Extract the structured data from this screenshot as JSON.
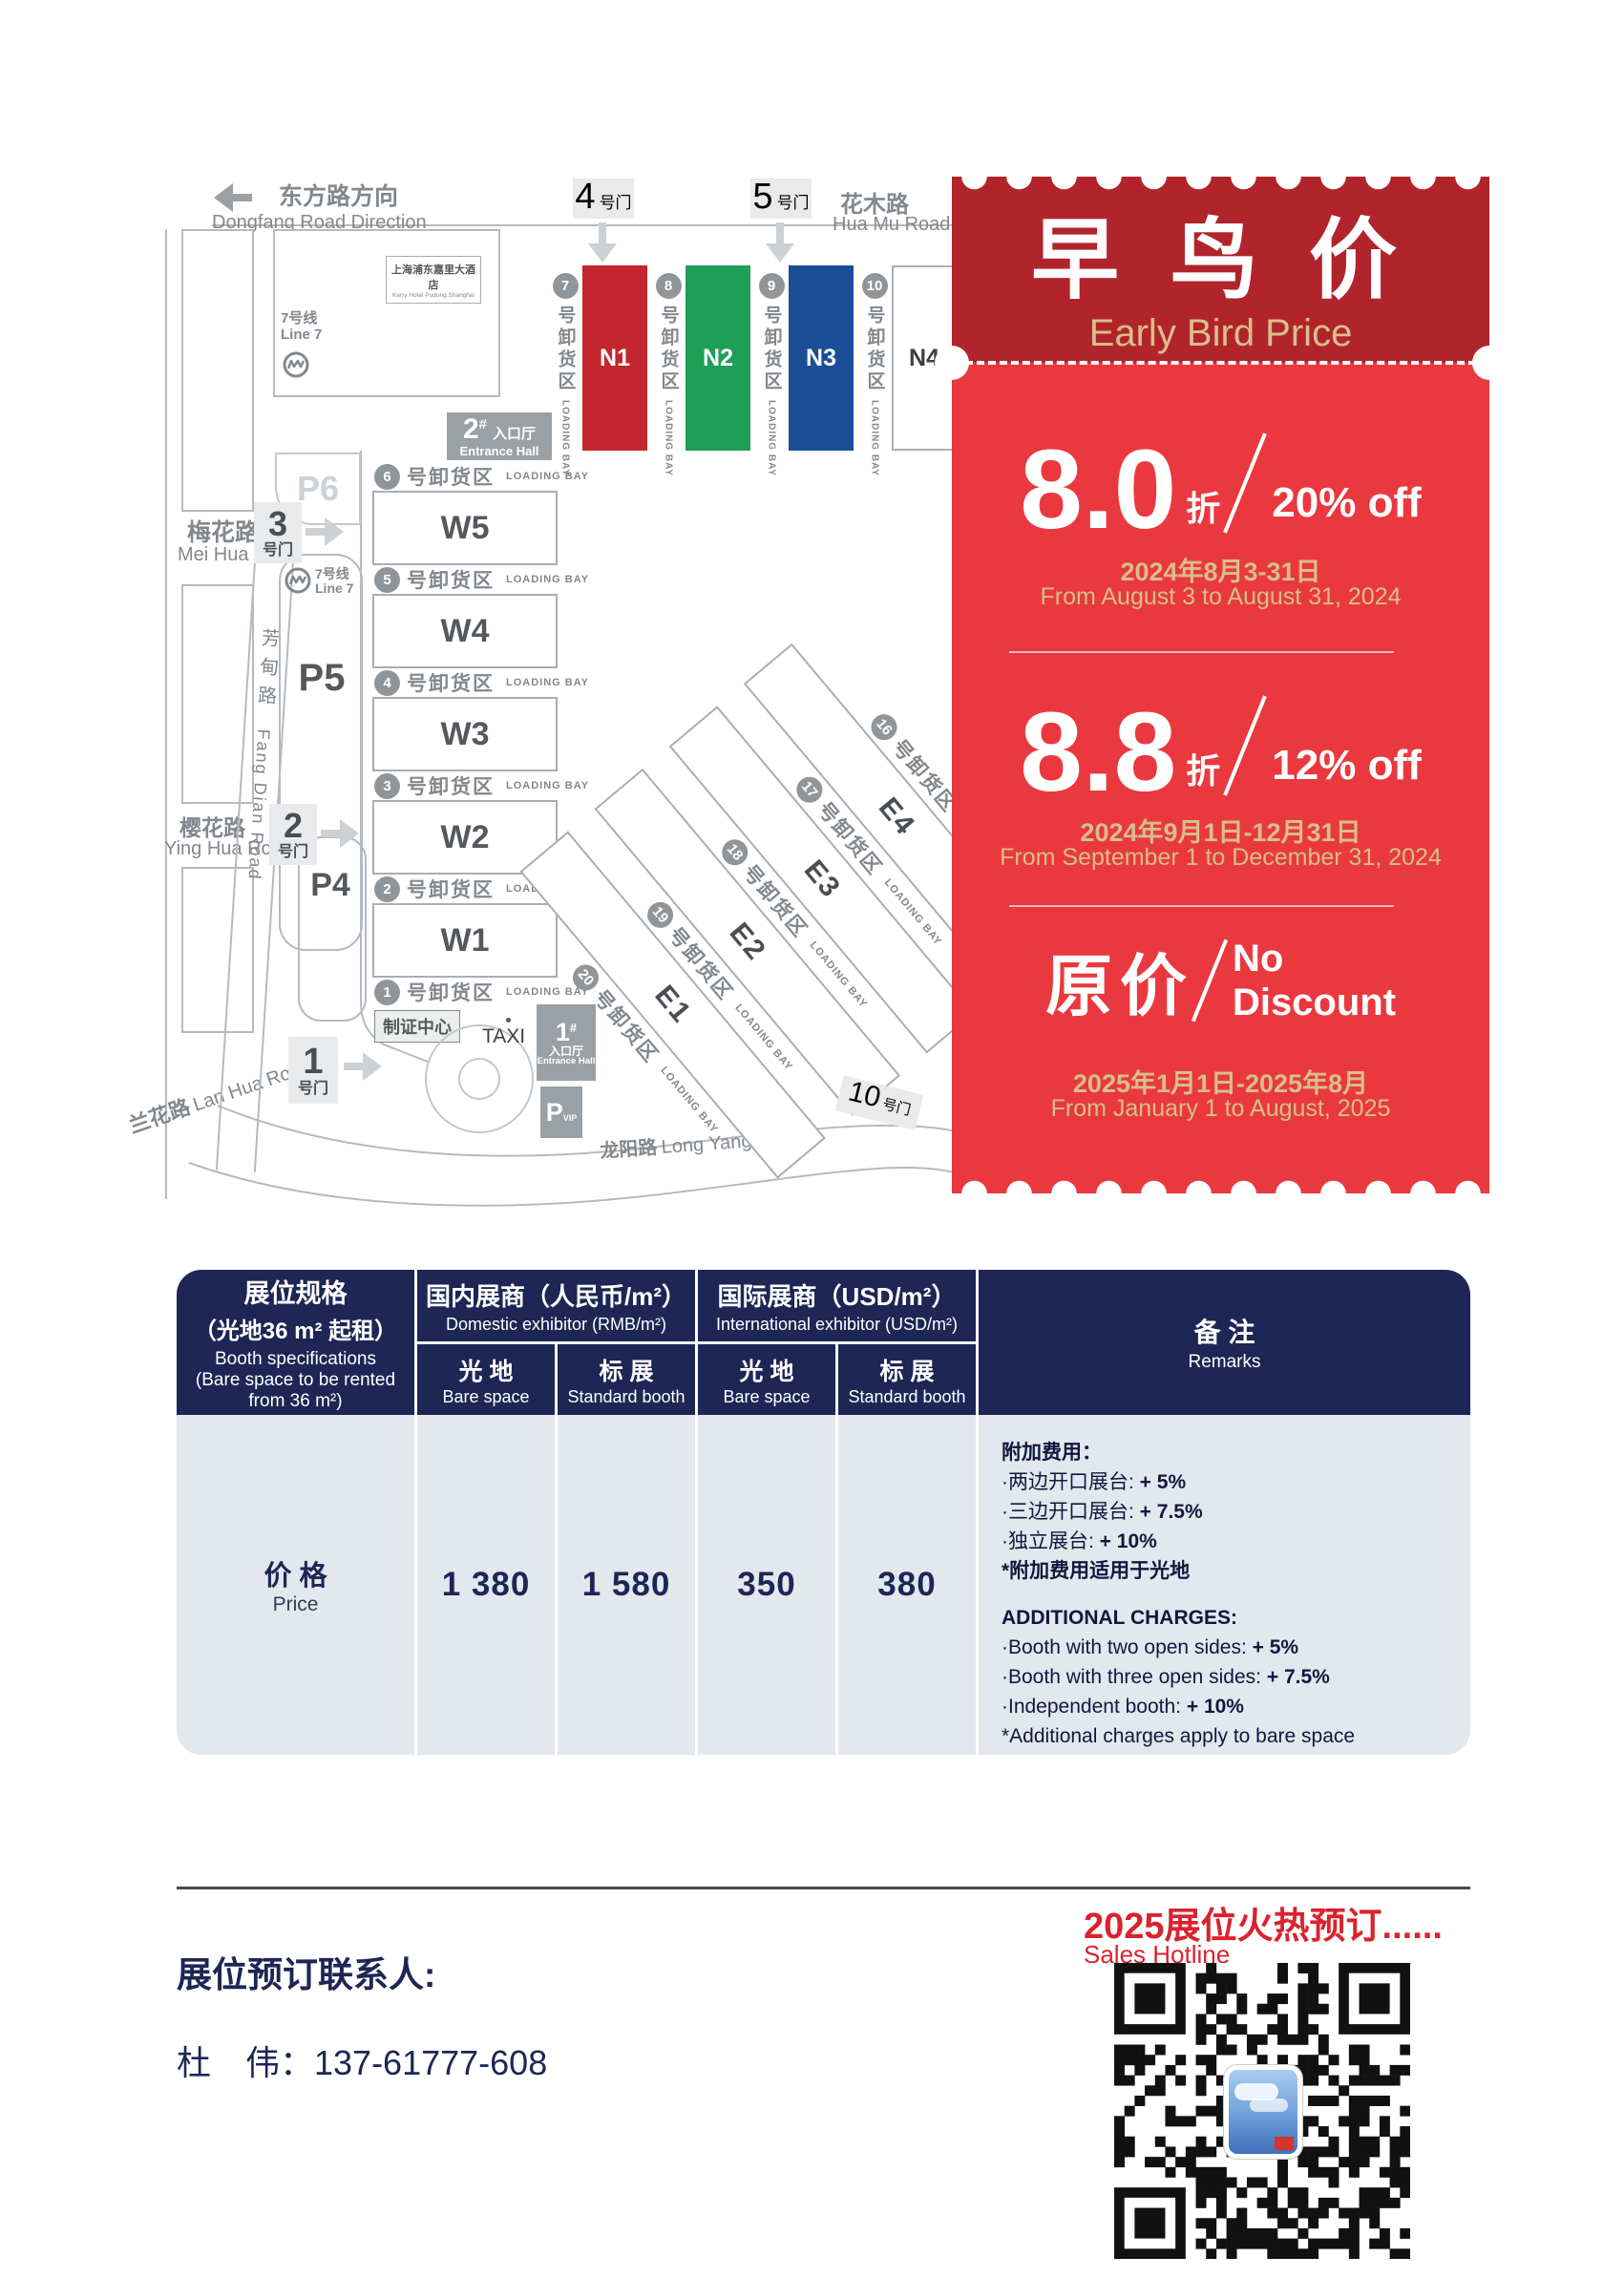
{
  "map": {
    "dongfang": {
      "zh": "东方路方向",
      "en": "Dongfang Road Direction"
    },
    "huamu": {
      "zh": "花木路",
      "en": "Hua Mu Road"
    },
    "meihua": {
      "zh": "梅花路",
      "en": "Mei Hua Road"
    },
    "yinghua": {
      "zh": "樱花路",
      "en": "Ying Hua Road"
    },
    "lanhua": {
      "zh": "兰花路",
      "en": "Lan Hua Road"
    },
    "fangdian": {
      "zh": "芳甸路",
      "en": "Fang Dian Road"
    },
    "longyang": {
      "zh": "龙阳路",
      "en": "Long Yang Road"
    },
    "line7": {
      "zh": "7号线",
      "en": "Line 7"
    },
    "hotel": {
      "zh": "上海浦东嘉里大酒店",
      "en": "Kerry Hotel Pudong Shanghai"
    },
    "gate_suffix": "号门",
    "gates": {
      "g1": "1",
      "g2": "2",
      "g3": "3",
      "g4": "4",
      "g5": "5",
      "g10": "10"
    },
    "parking": {
      "p4": "P4",
      "p5": "P5",
      "p6": "P6",
      "pvip": "P",
      "pvip_sub": "VIP"
    },
    "entrance": {
      "e1_num": "1",
      "e2_num": "2",
      "hash": "#",
      "hall_zh": "入口厅",
      "hall_en": "Entrance Hall"
    },
    "badge_center": "制证中心",
    "taxi": "TAXI",
    "bay": {
      "zh": "号卸货区",
      "en": "LOADING BAY"
    },
    "halls": {
      "n": [
        "N1",
        "N2",
        "N3",
        "N4"
      ],
      "w": [
        "W5",
        "W4",
        "W3",
        "W2",
        "W1"
      ],
      "e": [
        "E4",
        "E3",
        "E2",
        "E1"
      ]
    },
    "bays": {
      "n": [
        "7",
        "8",
        "9",
        "10"
      ],
      "w": [
        "6",
        "5",
        "4",
        "3",
        "2",
        "1"
      ],
      "e": [
        "16",
        "17",
        "18",
        "19",
        "20"
      ]
    }
  },
  "coupon": {
    "title_zh": "早 鸟 价",
    "title_en": "Early Bird Price",
    "tiers": [
      {
        "big": "8.0",
        "zhe": "折",
        "pct": "20% off",
        "date_zh": "2024年8月3-31日",
        "date_en": "From August 3 to August 31, 2024"
      },
      {
        "big": "8.8",
        "zhe": "折",
        "pct": "12% off",
        "date_zh": "2024年9月1日-12月31日",
        "date_en": "From September 1 to December 31, 2024"
      },
      {
        "big": "原价",
        "no1": "No",
        "no2": "Discount",
        "date_zh": "2025年1月1日-2025年8月",
        "date_en": "From January 1 to August, 2025"
      }
    ]
  },
  "table": {
    "spec": {
      "zh1": "展位规格",
      "zh2": "（光地36 m² 起租）",
      "en1": "Booth specifications",
      "en2": "(Bare space to be rented from 36 m²)"
    },
    "domestic": {
      "zh": "国内展商（人民币/m²）",
      "en": "Domestic exhibitor (RMB/m²)"
    },
    "international": {
      "zh": "国际展商（USD/m²）",
      "en": "International exhibitor (USD/m²)"
    },
    "sub": {
      "bare_zh": "光 地",
      "bare_en": "Bare space",
      "std_zh": "标 展",
      "std_en": "Standard booth"
    },
    "remarks_header": {
      "zh": "备 注",
      "en": "Remarks"
    },
    "price_row": {
      "zh": "价 格",
      "en": "Price",
      "values": [
        "1 380",
        "1 580",
        "350",
        "380"
      ]
    },
    "remarks": {
      "zh_title": "附加费用：",
      "zh_items": [
        {
          "t": "·两边开口展台: ",
          "v": "+ 5%"
        },
        {
          "t": "·三边开口展台: ",
          "v": "+ 7.5%"
        },
        {
          "t": "·独立展台: ",
          "v": "+ 10%"
        }
      ],
      "zh_note": "*附加费用适用于光地",
      "en_title": "ADDITIONAL CHARGES:",
      "en_items": [
        {
          "t": "·Booth with two open sides: ",
          "v": "+ 5%"
        },
        {
          "t": "·Booth with three open sides: ",
          "v": "+ 7.5%"
        },
        {
          "t": "·Independent booth: ",
          "v": "+ 10%"
        }
      ],
      "en_note": "*Additional charges apply to bare space"
    }
  },
  "footer": {
    "hot_zh": "2025展位火热预订......",
    "hot_en": "Sales Hotline",
    "contact_label": "展位预订联系人:",
    "contact_name": "杜　伟：137-61777-608"
  }
}
